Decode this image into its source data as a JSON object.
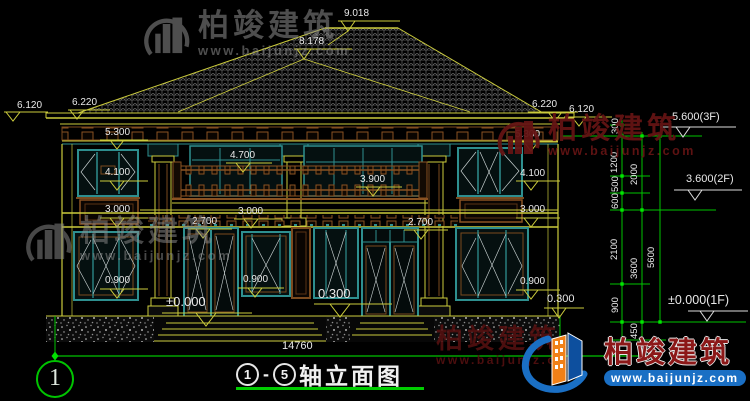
{
  "watermark": {
    "brand": "柏竣建筑",
    "url": "www.baijunjz.com"
  },
  "title": {
    "axis_from": "1",
    "axis_to": "5",
    "dash": "-",
    "text": "轴立面图"
  },
  "axis_bubble": "1",
  "dims": {
    "ridge": "9.018",
    "ridge2": "8.178",
    "eave_left_outer": "6.120",
    "eave_left": "6.220",
    "eave_right": "6.220",
    "eave_right_outer": "6.120",
    "fascia_left": "5.300",
    "fascia_right": "5.300",
    "win2_left": "4.100",
    "win2_right": "4.100",
    "balcony_top": "4.700",
    "balcony_mid": "3.900",
    "panel_left": "3.000",
    "panel_center": "3.000",
    "panel_right": "3.000",
    "band_left": "2.700",
    "band_right": "2.700",
    "sill_left": "0.900",
    "sill_center": "0.900",
    "sill_right": "0.900",
    "ground": "±0.000",
    "terrace": "0.300",
    "plinth_right": "0.300",
    "total_width": "14760"
  },
  "levels": {
    "floor3": "5.600(3F)",
    "floor2": "3.600(2F)",
    "floor1": "±0.000(1F)"
  },
  "chain": {
    "c300": "300",
    "c1200": "1200",
    "c500": "500",
    "c600": "600",
    "c2100": "2100",
    "c900": "900",
    "c450": "450",
    "c2000": "2000",
    "c3600": "3600",
    "c5600": "5600"
  },
  "colors": {
    "line_yellow": "#cbcb3c",
    "frame_teal": "#2e8f8f",
    "trim_brown": "#8a5222",
    "dim_white": "#e9e9e9",
    "axis_green": "#00c400",
    "watermark_gray": "#8f8f8f",
    "watermark_red": "#641414",
    "logo_blue": "#1a6fc4",
    "logo_orange": "#f08018"
  }
}
